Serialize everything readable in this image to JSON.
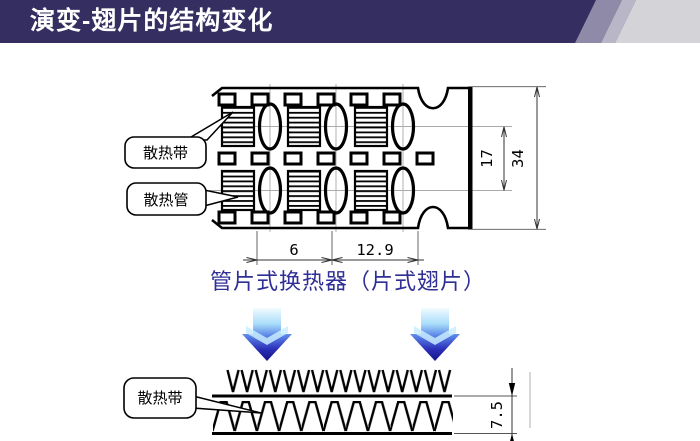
{
  "header": {
    "title": "演变-翅片的结构变化"
  },
  "diagram_top": {
    "callout_fin_strip": "散热带",
    "callout_tube": "散热管",
    "dim_tube_row_pitch": "17",
    "dim_core_width": "34",
    "dim_fin_section": "6",
    "dim_tube_section": "12.9",
    "caption": "管片式换热器（片式翅片）"
  },
  "diagram_bottom": {
    "callout_fin_strip": "散热带",
    "dim_fin_height": "7.5"
  },
  "colors": {
    "header_bar": "#342e61",
    "header_stripe_mid": "#8e8aa8",
    "header_stripe_light": "#b9b7c7",
    "header_end": "#d4d4d8",
    "caption_text": "#2f2f96",
    "arrow_gradient_top": "#f2fbff",
    "arrow_gradient_bottom": "#141286",
    "drawing_line": "#000000"
  }
}
